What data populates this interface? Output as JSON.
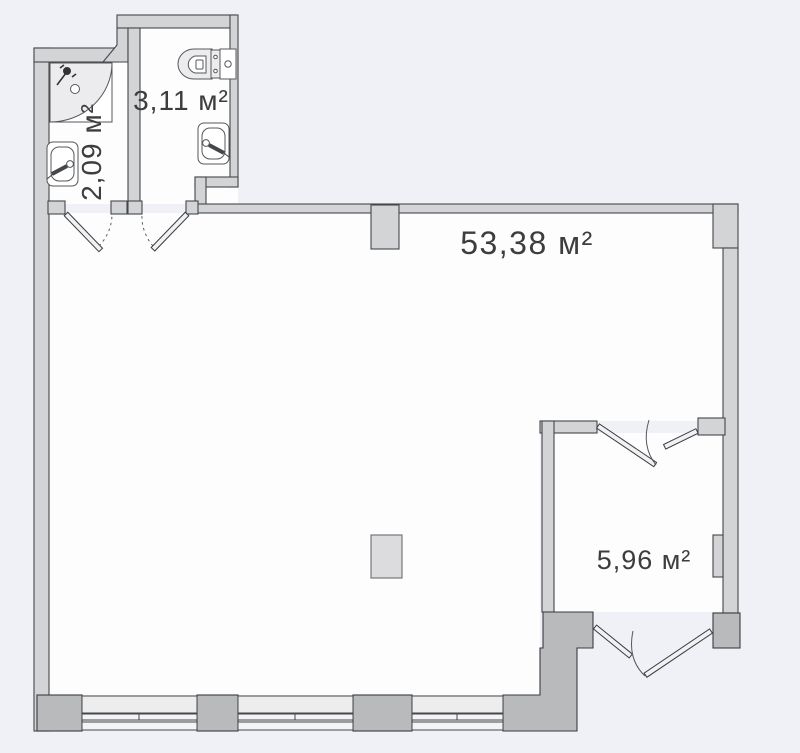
{
  "plan": {
    "title": "Apartment floor plan",
    "unit_suffix": "м²",
    "rooms": [
      {
        "id": "shower-room",
        "label": "2,09 м²",
        "area": "2,09"
      },
      {
        "id": "wc",
        "label": "3,11 м²",
        "area": "3,11"
      },
      {
        "id": "living-room",
        "label": "53,38 м²",
        "area": "53,38"
      },
      {
        "id": "balcony",
        "label": "5,96 м²",
        "area": "5,96"
      }
    ],
    "colors": {
      "background": "#eff1f6",
      "room_fill": "#fdfdfe",
      "wall_fill": "#d3d4d6",
      "pier_fill": "#b9babc",
      "window_fill": "#ededee",
      "window_band": "#f4f4f6",
      "stroke": "#45474b",
      "label_color": "#3d3d3d"
    }
  }
}
